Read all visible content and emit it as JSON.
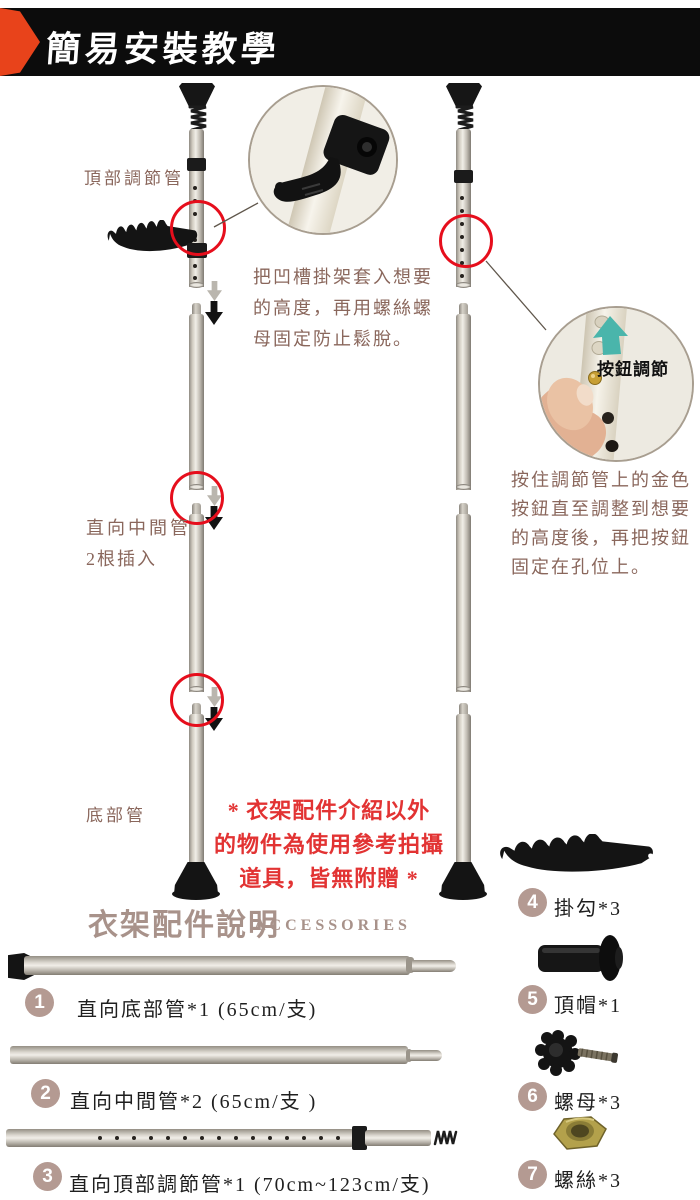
{
  "header": {
    "title": "簡易安裝教學"
  },
  "colors": {
    "header_bg": "#0c0c0c",
    "accent_red": "#e8431b",
    "highlight_red": "#e23333",
    "circle_red": "#e60e1c",
    "brand_taupe": "#b49a92",
    "text_brown": "#8a675c",
    "teal_arrow": "#4ab5ab"
  },
  "tutorial": {
    "label_top_tube": "頂部調節管",
    "label_middle_tube_line1": "直向中間管",
    "label_middle_tube_line2": "2根插入",
    "label_bottom_tube": "底部管",
    "step1_lines": [
      "把凹槽掛架套入想要",
      "的高度，再用螺絲螺",
      "母固定防止鬆脫。"
    ],
    "step2_lines": [
      "按住調節管上的金色",
      "按鈕直至調整到想要",
      "的高度後，再把按鈕",
      "固定在孔位上。"
    ],
    "button_adjust": "按鈕調節",
    "disclaimer_lines": [
      "* 衣架配件介紹以外",
      "的物件為使用參考拍攝",
      "道具，皆無附贈 *"
    ]
  },
  "accessories": {
    "heading": "衣架配件說明",
    "heading_en": "ACCESSORIES",
    "items": [
      {
        "num": "1",
        "label": "直向底部管*1 (65cm/支)"
      },
      {
        "num": "2",
        "label": "直向中間管*2 (65cm/支 )"
      },
      {
        "num": "3",
        "label": "直向頂部調節管*1 (70cm~123cm/支)"
      },
      {
        "num": "4",
        "label": "掛勾*3"
      },
      {
        "num": "5",
        "label": "頂帽*1"
      },
      {
        "num": "6",
        "label": "螺母*3"
      },
      {
        "num": "7",
        "label": "螺絲*3"
      }
    ]
  }
}
